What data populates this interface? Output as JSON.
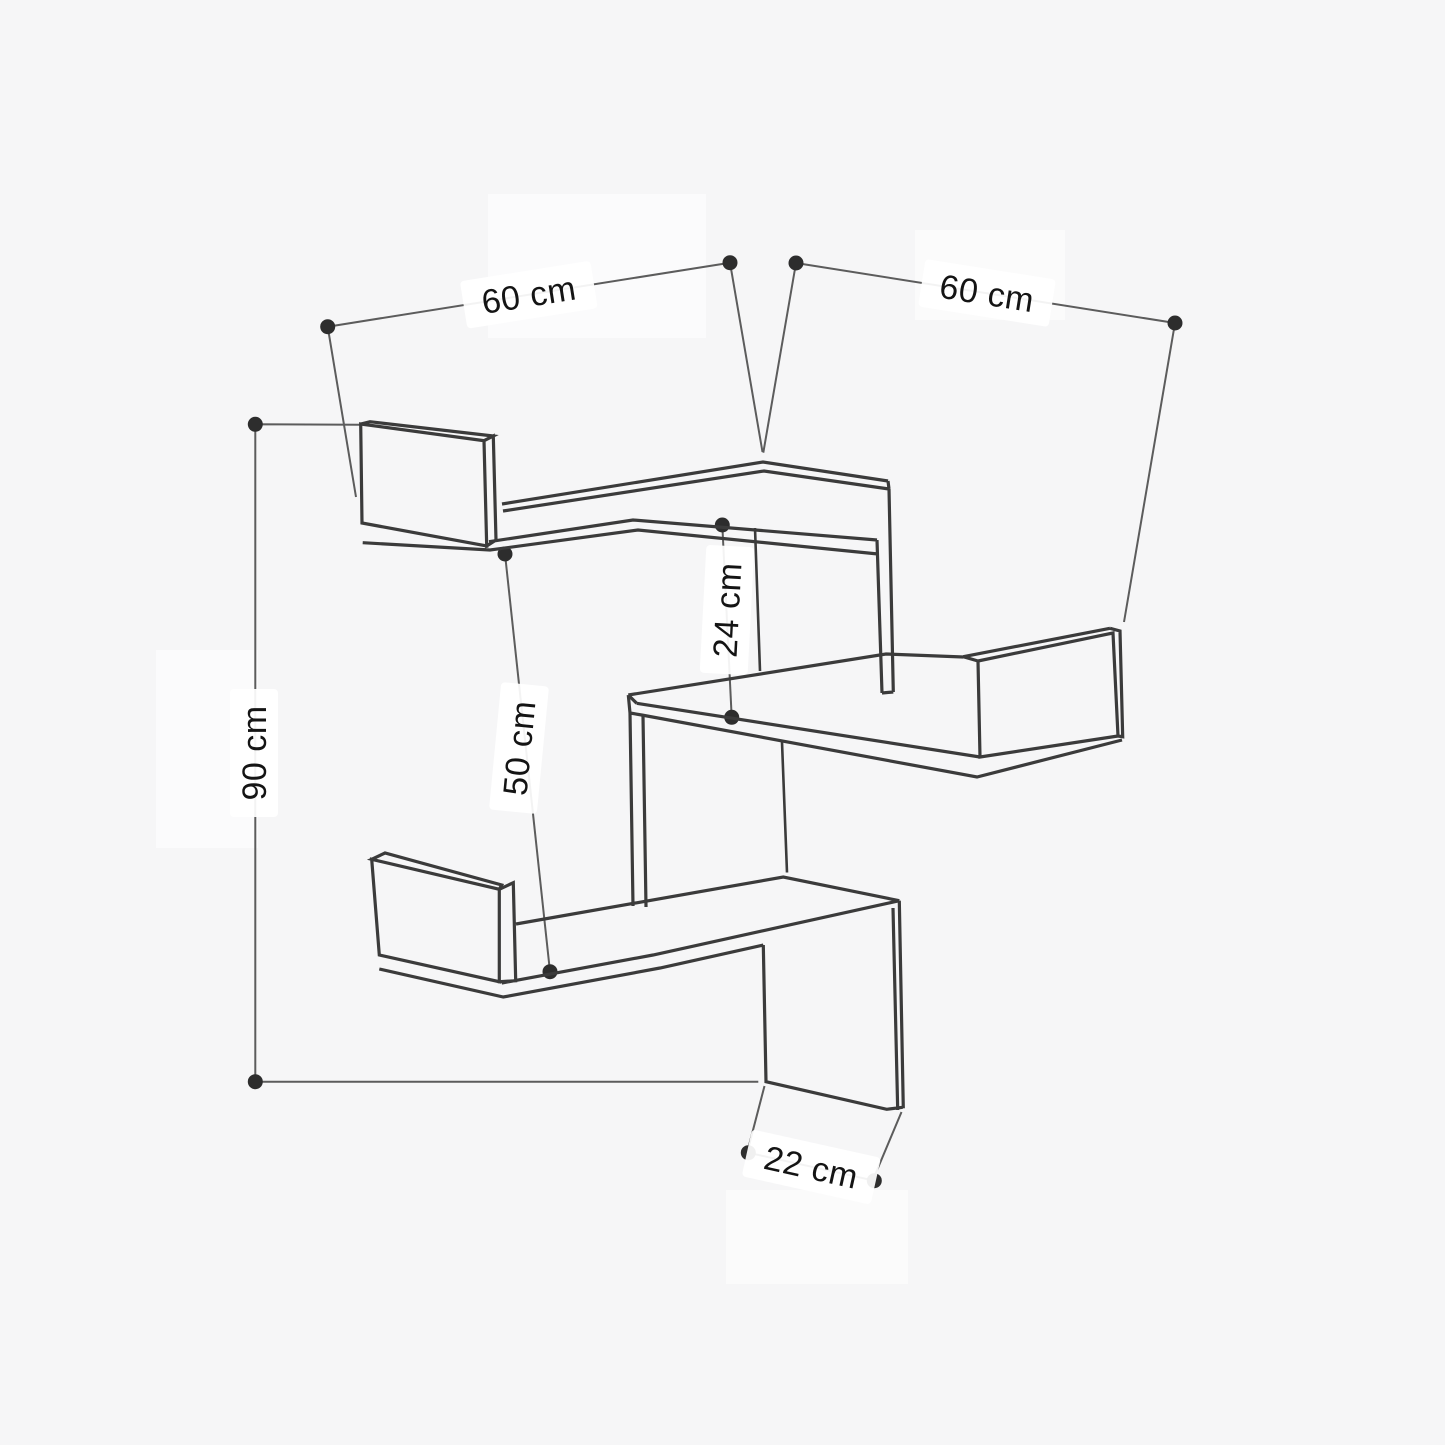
{
  "diagram": {
    "type": "furniture-dimension-drawing",
    "subject": "zigzag corner wall shelf, three tiers, isometric line drawing",
    "units": "cm",
    "dimensions": {
      "top_left_width": {
        "label": "60 cm",
        "value": 60
      },
      "top_right_width": {
        "label": "60 cm",
        "value": 60
      },
      "cubby_height": {
        "label": "24 cm",
        "value": 24
      },
      "mid_height": {
        "label": "50 cm",
        "value": 50
      },
      "total_height": {
        "label": "90 cm",
        "value": 90
      },
      "shelf_depth": {
        "label": "22 cm",
        "value": 22
      }
    },
    "colors": {
      "background": "#f6f6f7",
      "outline": "#3b3b3b",
      "dimension": "#5c5c5c",
      "dot": "#2d2d2d",
      "text": "#141414",
      "label_bg": "#ffffff"
    }
  }
}
